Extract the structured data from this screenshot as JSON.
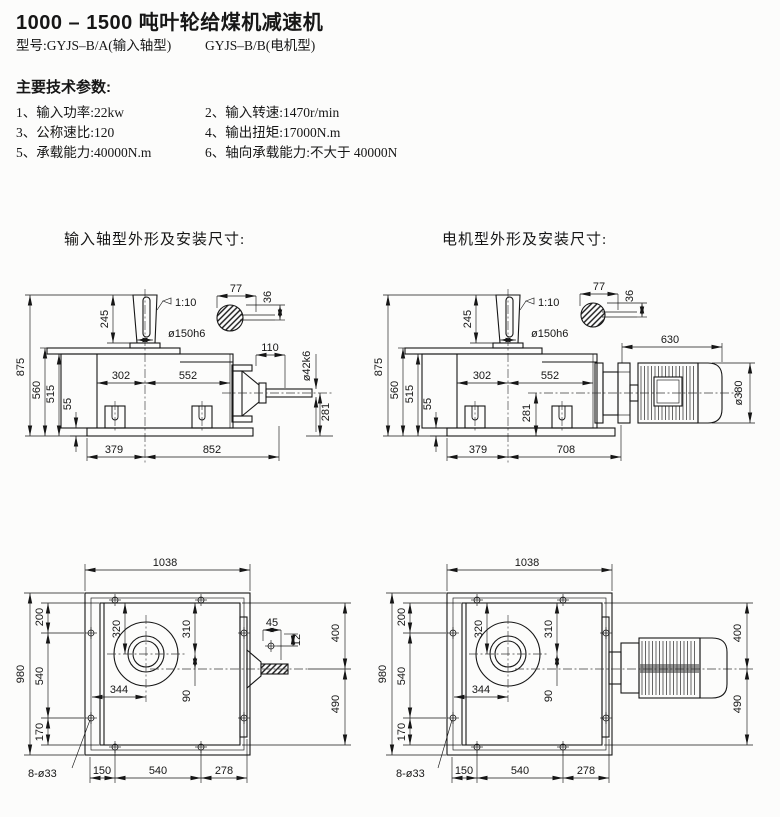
{
  "page": {
    "title": "1000 – 1500  吨叶轮给煤机减速机",
    "model_a": "型号:GYJS–B/A(输入轴型)",
    "model_b": "GYJS–B/B(电机型)"
  },
  "specs": {
    "heading": "主要技术参数:",
    "items": [
      "1、输入功率:22kw",
      "2、输入转速:1470r/min",
      "3、公称速比:120",
      "4、输出扭矩:17000N.m",
      "5、承载能力:40000N.m",
      "6、轴向承载能力:不大于 40000N"
    ]
  },
  "drawings": {
    "input_caption": "输入轴型外形及安装尺寸:",
    "motor_caption": "电机型外形及安装尺寸:"
  },
  "dims": {
    "875": "875",
    "560": "560",
    "515": "515",
    "55": "55",
    "245": "245",
    "taper": "1:10",
    "dia150": "ø150h6",
    "77": "77",
    "36": "36",
    "302": "302",
    "552": "552",
    "110": "110",
    "dia42": "ø42k6",
    "281": "281",
    "379": "379",
    "852": "852",
    "630": "630",
    "dia380": "ø380",
    "708": "708",
    "1038": "1038",
    "980": "980",
    "200": "200",
    "540": "540",
    "170": "170",
    "320": "320",
    "310": "310",
    "344": "344",
    "90": "90",
    "45": "45",
    "12": "12",
    "400": "400",
    "490": "490",
    "150": "150",
    "278": "278",
    "holes": "8-ø33"
  }
}
